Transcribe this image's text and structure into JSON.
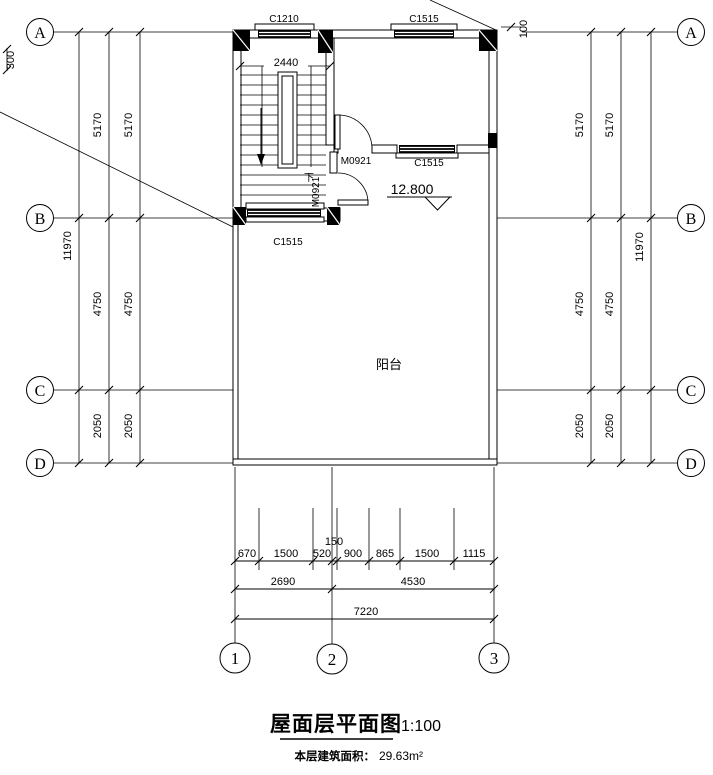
{
  "colors": {
    "ink": "#000000",
    "paper": "#ffffff"
  },
  "titleblock": {
    "title": "屋面层平面图",
    "scale": "1:100",
    "area_label": "本层建筑面积：",
    "area_value": "29.63m²"
  },
  "grid": {
    "rows": [
      "A",
      "B",
      "C",
      "D"
    ],
    "cols": [
      "1",
      "2",
      "3"
    ]
  },
  "dims": {
    "left": {
      "total": "11970",
      "ab": "5170",
      "bc": "4750",
      "cd": "2050"
    },
    "right": {
      "total": "11970",
      "ab": "5170",
      "bc": "4750",
      "cd": "2050"
    },
    "offset_left": "300",
    "offset_right": "100",
    "stair_width": "2440",
    "bottom": {
      "r1": [
        "670",
        "1500",
        "520",
        "150",
        "900",
        "865",
        "1500",
        "1115"
      ],
      "r2": [
        "2690",
        "4530"
      ],
      "total": "7220"
    }
  },
  "labels": {
    "window_c1210": "C1210",
    "window_c1515": "C1515",
    "door_m0921": "M0921",
    "stair_down": "下",
    "balcony": "阳台",
    "elevation": "12.800"
  }
}
